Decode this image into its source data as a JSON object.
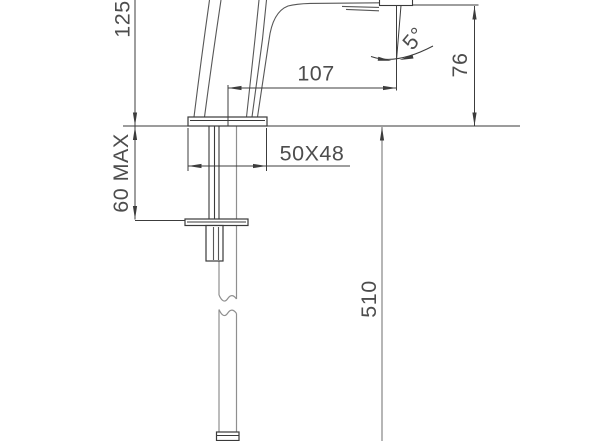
{
  "figure": "basin-faucet-side-elevation-technical-drawing",
  "dimensions": {
    "dim_125": "125",
    "dim_60_max": "60 MAX",
    "dim_107": "107",
    "dim_5_deg": "5°",
    "dim_76": "76",
    "dim_50x48": "50X48",
    "dim_510": "510"
  },
  "colors": {
    "background": "#ffffff",
    "outline_dark": "#3a3a3a",
    "outline_medium": "#575757",
    "hose_light": "#8f8f8f",
    "dimension_line": "#3c3c3c",
    "dimension_text": "#4d4d4d"
  }
}
